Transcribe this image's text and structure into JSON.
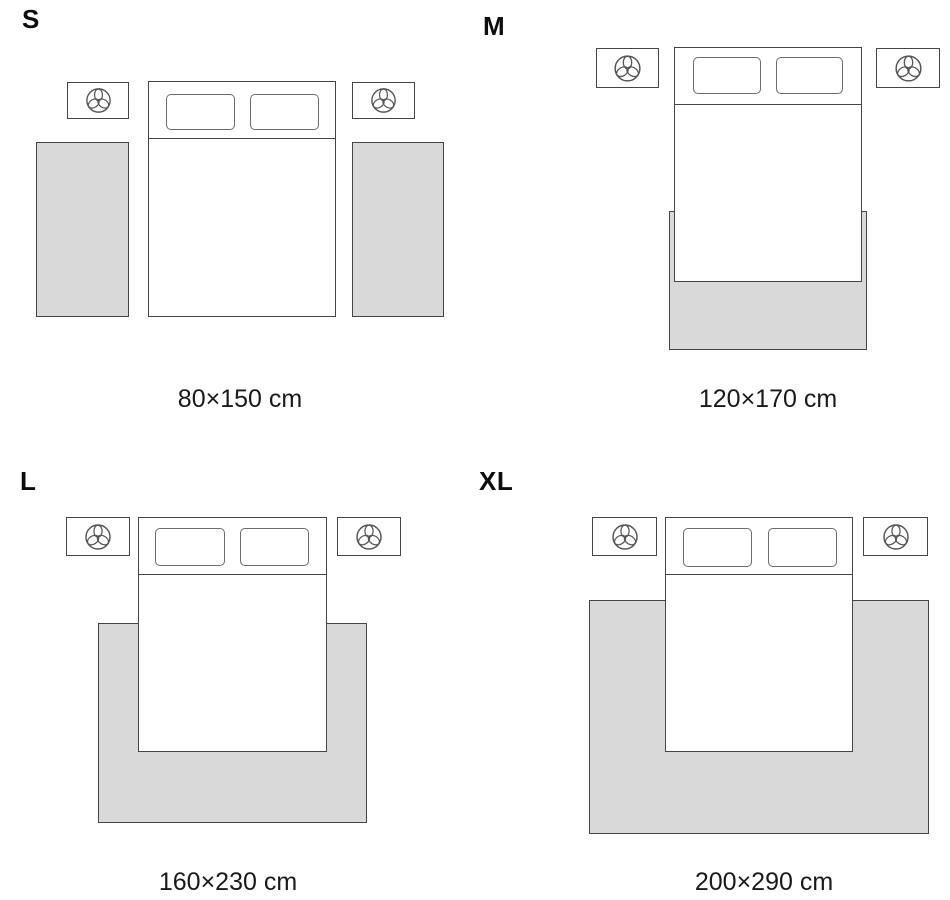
{
  "guide": {
    "sizes": [
      {
        "label": "S",
        "caption": "80×150 cm"
      },
      {
        "label": "M",
        "caption": "120×170 cm"
      },
      {
        "label": "L",
        "caption": "160×230 cm"
      },
      {
        "label": "XL",
        "caption": "200×290 cm"
      }
    ],
    "icons": {
      "nightstand_icon": "plant-icon"
    },
    "colors": {
      "outline": "#454545",
      "outline_soft": "#6b6b6b",
      "rug_fill": "#d9d9d9",
      "bed_fill": "#ffffff",
      "text": "#1a1a1a",
      "background": "#ffffff"
    }
  }
}
